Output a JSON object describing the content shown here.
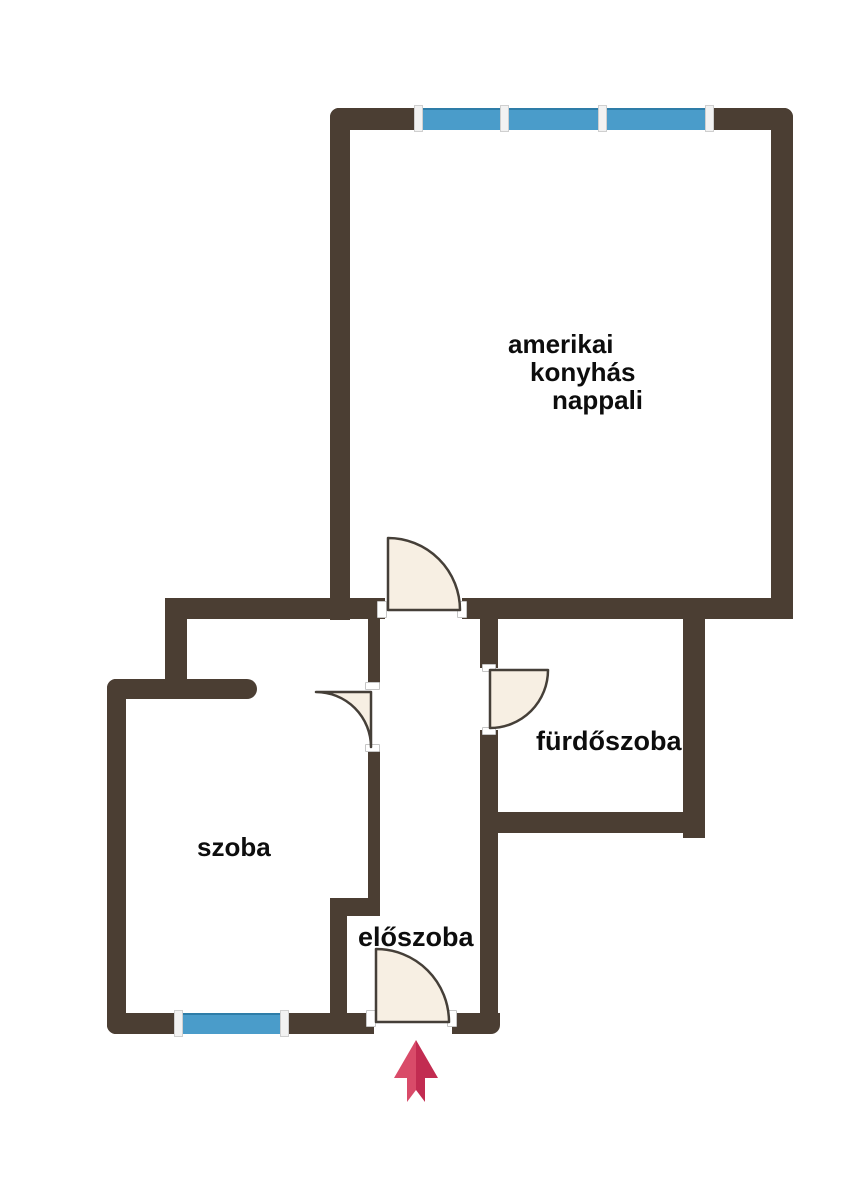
{
  "title": "apartment-floor-plan",
  "rooms": {
    "nappali": {
      "line1": "amerikai",
      "line2": "konyhás",
      "line3": "nappali",
      "full_label": "amerikai konyhás nappali"
    },
    "furdoszoba": {
      "label": "fürdőszoba"
    },
    "szoba": {
      "label": "szoba"
    },
    "eloszoba": {
      "label": "előszoba"
    }
  },
  "icons": {
    "entrance_arrow": "entrance-direction-up-arrow",
    "door_swing": "quarter-circle-door-swing",
    "window": "blue-window-band"
  },
  "counts": {
    "windows": 2,
    "window_panes_top": 3,
    "doors": 4
  },
  "colors": {
    "wall": "#4b3e33",
    "window": "#4a9cca",
    "window_edge": "#2e7da8",
    "door_fill": "#f7efe3",
    "door_stroke": "#453f38",
    "arrow_left": "#d94b69",
    "arrow_right": "#c22c51",
    "label": "#0d0d0d",
    "background": "#ffffff"
  }
}
